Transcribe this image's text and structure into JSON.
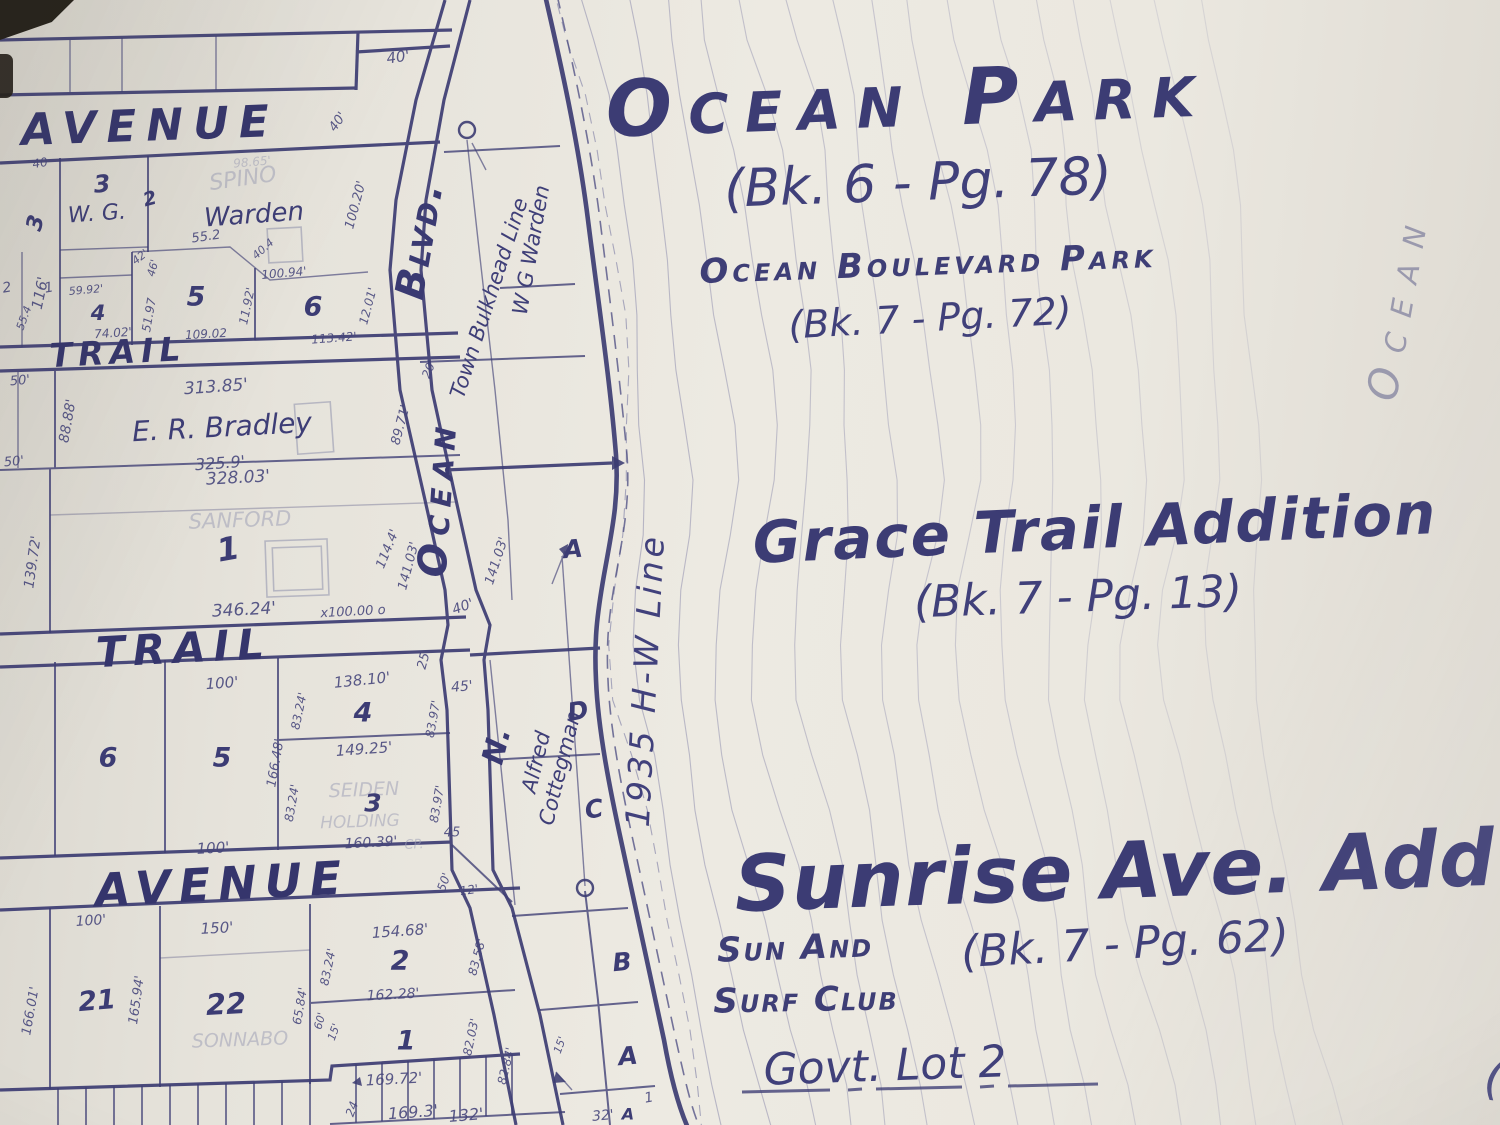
{
  "colors": {
    "ink": "#3d3d74",
    "ghost_ink": "#9ea0b6",
    "paper": "#eae7df",
    "shore_ink": "#3c3c72"
  },
  "map": {
    "labels": [
      {
        "t": "Ocean Park",
        "x": 908,
        "y": 100,
        "r": -2,
        "fs": 78,
        "c": "t1 sc",
        "ls": 16
      },
      {
        "t": "(Bk. 6 - Pg. 78)",
        "x": 918,
        "y": 183,
        "r": -2,
        "fs": 52,
        "c": "t2"
      },
      {
        "t": "Ocean Boulevard Park",
        "x": 928,
        "y": 264,
        "r": -2,
        "fs": 34,
        "c": "t3 sc",
        "ls": 4
      },
      {
        "t": "(Bk. 7 - Pg. 72)",
        "x": 930,
        "y": 318,
        "r": -3,
        "fs": 38,
        "c": "t2"
      },
      {
        "t": "Grace Trail Addition",
        "x": 1095,
        "y": 528,
        "r": -2.5,
        "fs": 58,
        "c": "t1",
        "ls": 2
      },
      {
        "t": "(Bk. 7 - Pg. 13)",
        "x": 1078,
        "y": 597,
        "r": -2,
        "fs": 44,
        "c": "t2"
      },
      {
        "t": "Sunrise Ave. Add",
        "x": 1115,
        "y": 872,
        "r": -2,
        "fs": 78,
        "c": "t1",
        "ls": 1
      },
      {
        "t": "Sun And",
        "x": 795,
        "y": 948,
        "r": -2,
        "fs": 34,
        "c": "t3 sc",
        "ls": 2
      },
      {
        "t": "(Bk. 7 - Pg. 62)",
        "x": 1125,
        "y": 944,
        "r": -3,
        "fs": 44,
        "c": "t2"
      },
      {
        "t": "Surf Club",
        "x": 806,
        "y": 1000,
        "r": -1,
        "fs": 34,
        "c": "t3 sc",
        "ls": 2
      },
      {
        "t": "Govt. Lot 2",
        "x": 885,
        "y": 1066,
        "r": -2,
        "fs": 44,
        "c": "t2"
      },
      {
        "t": "Ocean",
        "x": 1398,
        "y": 305,
        "r": -80,
        "fs": 42,
        "c": "vfaint sc",
        "ls": 16
      },
      {
        "t": "(",
        "x": 1494,
        "y": 1078,
        "r": 8,
        "fs": 48,
        "c": "t2"
      },
      {
        "t": "Blvd.",
        "x": 420,
        "y": 240,
        "r": -80,
        "fs": 40,
        "c": "road sc",
        "ls": 3
      },
      {
        "t": "Ocean",
        "x": 438,
        "y": 498,
        "r": -86,
        "fs": 40,
        "c": "road sc",
        "ls": 8
      },
      {
        "t": "N.",
        "x": 497,
        "y": 746,
        "r": -76,
        "fs": 30,
        "c": "road"
      },
      {
        "t": "Town Bulkhead Line",
        "x": 489,
        "y": 298,
        "r": -72,
        "fs": 21,
        "c": "vert"
      },
      {
        "t": "W G  Warden",
        "x": 531,
        "y": 250,
        "r": -80,
        "fs": 21,
        "c": "vert"
      },
      {
        "t": "Alfred",
        "x": 536,
        "y": 762,
        "r": -76,
        "fs": 21,
        "c": "vert"
      },
      {
        "t": "Cottegman",
        "x": 560,
        "y": 768,
        "r": -76,
        "fs": 21,
        "c": "vert"
      },
      {
        "t": "1935  H-W  Line",
        "x": 645,
        "y": 680,
        "r": -87,
        "fs": 33,
        "c": "shoretext",
        "ls": 4
      },
      {
        "t": "AVENUE",
        "x": 150,
        "y": 126,
        "r": -2,
        "fs": 44,
        "c": "street",
        "ls": 10
      },
      {
        "t": "TRAIL",
        "x": 118,
        "y": 352,
        "r": -3,
        "fs": 33,
        "c": "street",
        "ls": 6
      },
      {
        "t": "TRAIL",
        "x": 184,
        "y": 648,
        "r": -3,
        "fs": 42,
        "c": "street",
        "ls": 8
      },
      {
        "t": "AVENUE",
        "x": 222,
        "y": 884,
        "r": -3,
        "fs": 46,
        "c": "street",
        "ls": 8
      },
      {
        "t": "40'",
        "x": 398,
        "y": 57,
        "r": -8,
        "fs": 15,
        "c": "dim"
      },
      {
        "t": "40'",
        "x": 338,
        "y": 122,
        "r": -55,
        "fs": 13,
        "c": "dim"
      },
      {
        "t": "40",
        "x": 40,
        "y": 163,
        "r": -10,
        "fs": 12,
        "c": "dim"
      },
      {
        "t": "3",
        "x": 36,
        "y": 223,
        "r": -75,
        "fs": 22,
        "c": "num"
      },
      {
        "t": "116'",
        "x": 40,
        "y": 293,
        "r": -78,
        "fs": 15,
        "c": "dim"
      },
      {
        "t": "3",
        "x": 102,
        "y": 184,
        "r": -5,
        "fs": 24,
        "c": "num"
      },
      {
        "t": "W. G.",
        "x": 97,
        "y": 214,
        "r": -4,
        "fs": 22,
        "c": "name"
      },
      {
        "t": "2",
        "x": 150,
        "y": 199,
        "r": -15,
        "fs": 19,
        "c": "num"
      },
      {
        "t": "SPINO",
        "x": 243,
        "y": 179,
        "r": -8,
        "fs": 22,
        "c": "ghost"
      },
      {
        "t": "Warden",
        "x": 254,
        "y": 215,
        "r": -4,
        "fs": 26,
        "c": "name"
      },
      {
        "t": "98.65'",
        "x": 252,
        "y": 162,
        "r": -5,
        "fs": 12,
        "c": "ghost"
      },
      {
        "t": "55.2",
        "x": 206,
        "y": 237,
        "r": -8,
        "fs": 13,
        "c": "dim"
      },
      {
        "t": "40.4",
        "x": 263,
        "y": 249,
        "r": -42,
        "fs": 11,
        "c": "dim"
      },
      {
        "t": "42'",
        "x": 140,
        "y": 257,
        "r": -38,
        "fs": 11,
        "c": "dim"
      },
      {
        "t": "46'",
        "x": 153,
        "y": 268,
        "r": -75,
        "fs": 11,
        "c": "dim"
      },
      {
        "t": "100.20'",
        "x": 356,
        "y": 205,
        "r": -75,
        "fs": 13,
        "c": "dim"
      },
      {
        "t": "5",
        "x": 196,
        "y": 297,
        "r": 0,
        "fs": 27,
        "c": "num"
      },
      {
        "t": "6",
        "x": 313,
        "y": 307,
        "r": 0,
        "fs": 27,
        "c": "num"
      },
      {
        "t": "100.94'",
        "x": 284,
        "y": 273,
        "r": -5,
        "fs": 12,
        "c": "dim"
      },
      {
        "t": "11.92'",
        "x": 247,
        "y": 306,
        "r": -78,
        "fs": 12,
        "c": "dim"
      },
      {
        "t": "12.01'",
        "x": 368,
        "y": 306,
        "r": -75,
        "fs": 12,
        "c": "dim"
      },
      {
        "t": "59.92'",
        "x": 86,
        "y": 290,
        "r": -5,
        "fs": 11,
        "c": "dim"
      },
      {
        "t": "4",
        "x": 98,
        "y": 313,
        "r": 0,
        "fs": 21,
        "c": "num"
      },
      {
        "t": "1",
        "x": 49,
        "y": 288,
        "r": -10,
        "fs": 14,
        "c": "dim"
      },
      {
        "t": "2",
        "x": 7,
        "y": 288,
        "r": -10,
        "fs": 14,
        "c": "dim"
      },
      {
        "t": "55.4",
        "x": 24,
        "y": 318,
        "r": -70,
        "fs": 11,
        "c": "dim"
      },
      {
        "t": "74.02'",
        "x": 113,
        "y": 333,
        "r": -4,
        "fs": 12,
        "c": "dim"
      },
      {
        "t": "51.97",
        "x": 149,
        "y": 315,
        "r": -80,
        "fs": 12,
        "c": "dim"
      },
      {
        "t": "109.02",
        "x": 206,
        "y": 334,
        "r": -3,
        "fs": 12,
        "c": "dim"
      },
      {
        "t": "113.42'",
        "x": 334,
        "y": 338,
        "r": -4,
        "fs": 12,
        "c": "dim"
      },
      {
        "t": "50'",
        "x": 20,
        "y": 381,
        "r": -5,
        "fs": 13,
        "c": "dim"
      },
      {
        "t": "50'",
        "x": 14,
        "y": 462,
        "r": -5,
        "fs": 13,
        "c": "dim"
      },
      {
        "t": "88.88'",
        "x": 68,
        "y": 421,
        "r": -80,
        "fs": 14,
        "c": "dim"
      },
      {
        "t": "313.85'",
        "x": 216,
        "y": 387,
        "r": -4,
        "fs": 17,
        "c": "dim"
      },
      {
        "t": "E. R. Bradley",
        "x": 222,
        "y": 427,
        "r": -3,
        "fs": 28,
        "c": "name"
      },
      {
        "t": "325.9'",
        "x": 220,
        "y": 463,
        "r": -4,
        "fs": 16,
        "c": "dim"
      },
      {
        "t": "89.71'",
        "x": 401,
        "y": 425,
        "r": -75,
        "fs": 13,
        "c": "dim"
      },
      {
        "t": "20'",
        "x": 429,
        "y": 369,
        "r": -68,
        "fs": 12,
        "c": "dim"
      },
      {
        "t": "328.03'",
        "x": 238,
        "y": 478,
        "r": -3,
        "fs": 17,
        "c": "dim"
      },
      {
        "t": "SANFORD",
        "x": 240,
        "y": 520,
        "r": -2,
        "fs": 21,
        "c": "ghost"
      },
      {
        "t": "1",
        "x": 228,
        "y": 549,
        "r": -10,
        "fs": 32,
        "c": "num"
      },
      {
        "t": "139.72'",
        "x": 33,
        "y": 562,
        "r": -82,
        "fs": 14,
        "c": "dim"
      },
      {
        "t": "114.4'",
        "x": 388,
        "y": 549,
        "r": -68,
        "fs": 13,
        "c": "dim"
      },
      {
        "t": "141.03'",
        "x": 409,
        "y": 566,
        "r": -75,
        "fs": 13,
        "c": "dim"
      },
      {
        "t": "141.03'",
        "x": 497,
        "y": 561,
        "r": -72,
        "fs": 13,
        "c": "dim"
      },
      {
        "t": "346.24'",
        "x": 244,
        "y": 610,
        "r": -3,
        "fs": 17,
        "c": "dim"
      },
      {
        "t": "x100.00 o",
        "x": 353,
        "y": 612,
        "r": -3,
        "fs": 13,
        "c": "dim"
      },
      {
        "t": "40'",
        "x": 463,
        "y": 607,
        "r": -20,
        "fs": 14,
        "c": "dim"
      },
      {
        "t": "25",
        "x": 424,
        "y": 661,
        "r": -75,
        "fs": 13,
        "c": "dim"
      },
      {
        "t": "A",
        "x": 573,
        "y": 549,
        "r": -5,
        "fs": 25,
        "c": "num"
      },
      {
        "t": "100'",
        "x": 222,
        "y": 683,
        "r": -4,
        "fs": 15,
        "c": "dim"
      },
      {
        "t": "138.10'",
        "x": 362,
        "y": 680,
        "r": -6,
        "fs": 15,
        "c": "dim"
      },
      {
        "t": "45'",
        "x": 462,
        "y": 687,
        "r": -5,
        "fs": 14,
        "c": "dim"
      },
      {
        "t": "83.24'",
        "x": 299,
        "y": 711,
        "r": -78,
        "fs": 12,
        "c": "dim"
      },
      {
        "t": "4",
        "x": 363,
        "y": 713,
        "r": 0,
        "fs": 27,
        "c": "num"
      },
      {
        "t": "83.97'",
        "x": 433,
        "y": 719,
        "r": -80,
        "fs": 12,
        "c": "dim"
      },
      {
        "t": "6",
        "x": 108,
        "y": 758,
        "r": 0,
        "fs": 27,
        "c": "num"
      },
      {
        "t": "5",
        "x": 222,
        "y": 758,
        "r": 0,
        "fs": 27,
        "c": "num"
      },
      {
        "t": "149.25'",
        "x": 364,
        "y": 749,
        "r": -4,
        "fs": 15,
        "c": "dim"
      },
      {
        "t": "166.48'",
        "x": 276,
        "y": 763,
        "r": -80,
        "fs": 13,
        "c": "dim"
      },
      {
        "t": "83.24'",
        "x": 292,
        "y": 803,
        "r": -80,
        "fs": 12,
        "c": "dim"
      },
      {
        "t": "SEIDEN",
        "x": 364,
        "y": 790,
        "r": -2,
        "fs": 19,
        "c": "ghost"
      },
      {
        "t": "3",
        "x": 373,
        "y": 803,
        "r": 0,
        "fs": 25,
        "c": "num"
      },
      {
        "t": "HOLDING",
        "x": 360,
        "y": 822,
        "r": -2,
        "fs": 17,
        "c": "ghost"
      },
      {
        "t": "100'",
        "x": 213,
        "y": 848,
        "r": -3,
        "fs": 15,
        "c": "dim"
      },
      {
        "t": "160.39'",
        "x": 371,
        "y": 843,
        "r": -3,
        "fs": 14,
        "c": "dim"
      },
      {
        "t": "CP.",
        "x": 414,
        "y": 845,
        "r": -3,
        "fs": 13,
        "c": "ghost"
      },
      {
        "t": "83.97'",
        "x": 437,
        "y": 804,
        "r": -80,
        "fs": 12,
        "c": "dim"
      },
      {
        "t": "45",
        "x": 452,
        "y": 833,
        "r": 0,
        "fs": 13,
        "c": "dim"
      },
      {
        "t": "50'",
        "x": 444,
        "y": 882,
        "r": -70,
        "fs": 12,
        "c": "dim"
      },
      {
        "t": "12'",
        "x": 469,
        "y": 890,
        "r": -8,
        "fs": 12,
        "c": "dim"
      },
      {
        "t": "D",
        "x": 578,
        "y": 711,
        "r": -10,
        "fs": 25,
        "c": "num"
      },
      {
        "t": "C",
        "x": 594,
        "y": 809,
        "r": -8,
        "fs": 25,
        "c": "num"
      },
      {
        "t": "B",
        "x": 622,
        "y": 962,
        "r": -5,
        "fs": 25,
        "c": "num"
      },
      {
        "t": "A",
        "x": 628,
        "y": 1056,
        "r": -5,
        "fs": 25,
        "c": "num"
      },
      {
        "t": "100'",
        "x": 91,
        "y": 921,
        "r": -4,
        "fs": 14,
        "c": "dim"
      },
      {
        "t": "150'",
        "x": 217,
        "y": 928,
        "r": -3,
        "fs": 15,
        "c": "dim"
      },
      {
        "t": "154.68'",
        "x": 400,
        "y": 931,
        "r": -4,
        "fs": 15,
        "c": "dim"
      },
      {
        "t": "83.24'",
        "x": 328,
        "y": 967,
        "r": -78,
        "fs": 12,
        "c": "dim"
      },
      {
        "t": "2",
        "x": 400,
        "y": 961,
        "r": 0,
        "fs": 27,
        "c": "num"
      },
      {
        "t": "162.28'",
        "x": 393,
        "y": 995,
        "r": -3,
        "fs": 14,
        "c": "dim"
      },
      {
        "t": "83.58'",
        "x": 477,
        "y": 957,
        "r": -75,
        "fs": 12,
        "c": "dim"
      },
      {
        "t": "21",
        "x": 97,
        "y": 1001,
        "r": -5,
        "fs": 27,
        "c": "num"
      },
      {
        "t": "166.01'",
        "x": 31,
        "y": 1011,
        "r": -80,
        "fs": 13,
        "c": "dim"
      },
      {
        "t": "165.94'",
        "x": 137,
        "y": 1000,
        "r": -82,
        "fs": 13,
        "c": "dim"
      },
      {
        "t": "22",
        "x": 226,
        "y": 1004,
        "r": -3,
        "fs": 29,
        "c": "num"
      },
      {
        "t": "SONNABO",
        "x": 240,
        "y": 1040,
        "r": -2,
        "fs": 19,
        "c": "ghost"
      },
      {
        "t": "65.84'",
        "x": 300,
        "y": 1006,
        "r": -80,
        "fs": 12,
        "c": "dim"
      },
      {
        "t": "60'",
        "x": 320,
        "y": 1021,
        "r": -75,
        "fs": 11,
        "c": "dim"
      },
      {
        "t": "15'",
        "x": 334,
        "y": 1032,
        "r": -70,
        "fs": 11,
        "c": "dim"
      },
      {
        "t": "1",
        "x": 406,
        "y": 1041,
        "r": 0,
        "fs": 27,
        "c": "num"
      },
      {
        "t": "169.72'",
        "x": 394,
        "y": 1079,
        "r": -3,
        "fs": 15,
        "c": "dim"
      },
      {
        "t": "82.03'",
        "x": 471,
        "y": 1037,
        "r": -78,
        "fs": 12,
        "c": "dim"
      },
      {
        "t": "82.84'",
        "x": 506,
        "y": 1066,
        "r": -76,
        "fs": 12,
        "c": "dim"
      },
      {
        "t": "24",
        "x": 352,
        "y": 1109,
        "r": -70,
        "fs": 12,
        "c": "dim"
      },
      {
        "t": "169.3'",
        "x": 413,
        "y": 1112,
        "r": -4,
        "fs": 16,
        "c": "dim"
      },
      {
        "t": "132'",
        "x": 466,
        "y": 1115,
        "r": -5,
        "fs": 16,
        "c": "dim"
      },
      {
        "t": "32'",
        "x": 603,
        "y": 1116,
        "r": -5,
        "fs": 14,
        "c": "dim"
      },
      {
        "t": "A",
        "x": 628,
        "y": 1114,
        "r": 0,
        "fs": 16,
        "c": "num"
      },
      {
        "t": "1",
        "x": 649,
        "y": 1098,
        "r": -10,
        "fs": 14,
        "c": "dim"
      },
      {
        "t": "15'",
        "x": 560,
        "y": 1045,
        "r": -70,
        "fs": 11,
        "c": "dim"
      }
    ]
  }
}
